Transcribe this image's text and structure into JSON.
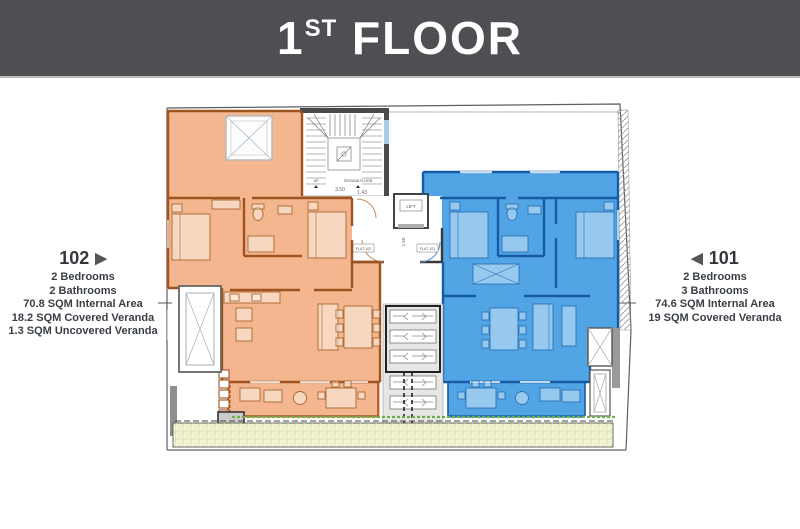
{
  "header": {
    "title_num": "1",
    "title_sup": "ST",
    "title_rest": " FLOOR"
  },
  "apartments": {
    "flat_102": {
      "number": "102",
      "marker": "▶",
      "specs": [
        "2 Bedrooms",
        "2 Bathrooms",
        "70.8 SQM Internal Area",
        "18.2 SQM Covered Veranda",
        "1.3 SQM Uncovered Veranda"
      ]
    },
    "flat_101": {
      "number": "101",
      "marker": "◀",
      "specs": [
        "2 Bedrooms",
        "3 Bathrooms",
        "74.6 SQM Internal Area",
        "19 SQM Covered Veranda"
      ]
    }
  },
  "plan": {
    "lift_label": "LIFT",
    "flat_left_tag": "FLAT 102",
    "flat_right_tag": "FLAT 101",
    "stair_dim": "3.50",
    "landing_dim": "1.43",
    "lobby_dim": "1.50",
    "stair_up_note": "UP",
    "stair_down_note": "GROUND FLOOR"
  },
  "colors": {
    "header_bg": "#504D53",
    "flat_102_fill": "#F1A97B",
    "flat_102_wall": "#A0521F",
    "flat_101_fill": "#3F9BE2",
    "flat_101_wall": "#175AA5",
    "garden_fill": "#F2F4D4",
    "text": "#3A3F45"
  }
}
